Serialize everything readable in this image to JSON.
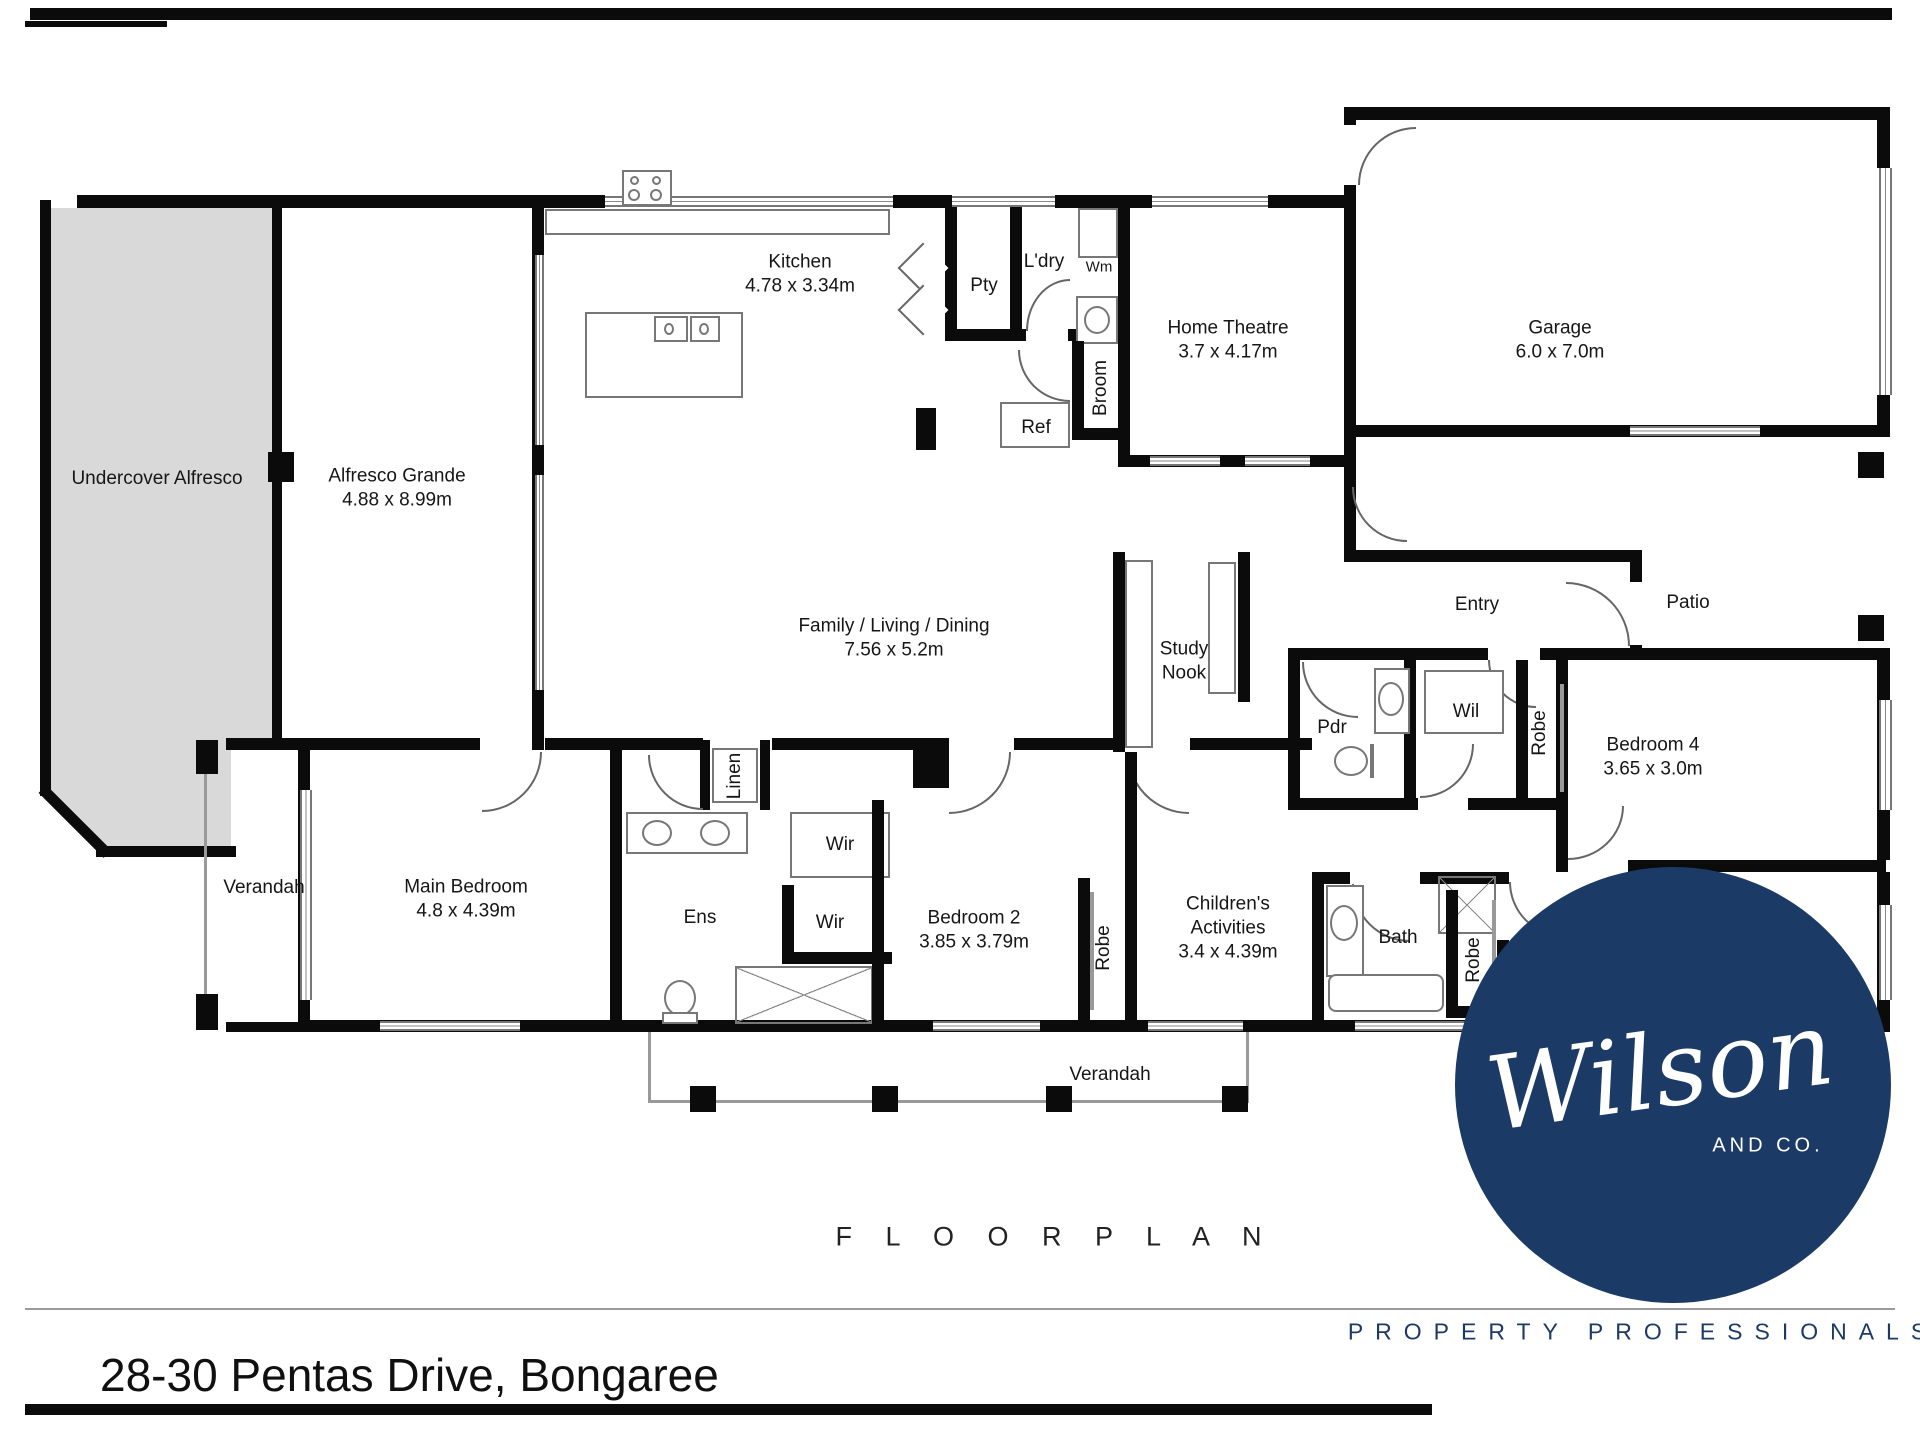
{
  "branding": {
    "address": "28-30 Pentas Drive, Bongaree",
    "floor_plan_title": "F L O O R   P L A N",
    "logo_name": "Wilson",
    "logo_sub": "AND CO.",
    "logo_tagline": "PROPERTY PROFESSIONALS",
    "navy": "#1b3a66",
    "gray_fill": "#d9d9d9",
    "wall_color": "#0b0b0b"
  },
  "plan": {
    "rooms": [
      {
        "id": "undercover-alfresco",
        "lines": [
          "Undercover Alfresco"
        ],
        "x": 157,
        "y": 479
      },
      {
        "id": "alfresco-grande",
        "lines": [
          "Alfresco Grande",
          "4.88 x 8.99m"
        ],
        "x": 397,
        "y": 488
      },
      {
        "id": "kitchen",
        "lines": [
          "Kitchen",
          "4.78 x 3.34m"
        ],
        "x": 800,
        "y": 274
      },
      {
        "id": "pty",
        "lines": [
          "Pty"
        ],
        "x": 984,
        "y": 286
      },
      {
        "id": "ldry",
        "lines": [
          "L'dry"
        ],
        "x": 1044,
        "y": 262
      },
      {
        "id": "wm",
        "lines": [
          "Wm"
        ],
        "x": 1099,
        "y": 268,
        "size": 15
      },
      {
        "id": "broom",
        "lines": [
          "Broom"
        ],
        "x": 1101,
        "y": 388,
        "vertical": true
      },
      {
        "id": "ref",
        "lines": [
          "Ref"
        ],
        "x": 1036,
        "y": 428
      },
      {
        "id": "home-theatre",
        "lines": [
          "Home Theatre",
          "3.7 x 4.17m"
        ],
        "x": 1228,
        "y": 340
      },
      {
        "id": "garage",
        "lines": [
          "Garage",
          "6.0 x 7.0m"
        ],
        "x": 1560,
        "y": 340
      },
      {
        "id": "family-living-dining",
        "lines": [
          "Family / Living / Dining",
          "7.56 x 5.2m"
        ],
        "x": 894,
        "y": 638
      },
      {
        "id": "study-nook",
        "lines": [
          "Study",
          "Nook"
        ],
        "x": 1184,
        "y": 661
      },
      {
        "id": "entry",
        "lines": [
          "Entry"
        ],
        "x": 1477,
        "y": 605
      },
      {
        "id": "patio",
        "lines": [
          "Patio"
        ],
        "x": 1688,
        "y": 603
      },
      {
        "id": "pdr",
        "lines": [
          "Pdr"
        ],
        "x": 1332,
        "y": 728
      },
      {
        "id": "wil",
        "lines": [
          "Wil"
        ],
        "x": 1466,
        "y": 712
      },
      {
        "id": "robe-bed4",
        "lines": [
          "Robe"
        ],
        "x": 1540,
        "y": 733,
        "vertical": true
      },
      {
        "id": "bedroom4",
        "lines": [
          "Bedroom 4",
          "3.65 x 3.0m"
        ],
        "x": 1653,
        "y": 757
      },
      {
        "id": "verandah-left",
        "lines": [
          "Verandah"
        ],
        "x": 264,
        "y": 888
      },
      {
        "id": "main-bedroom",
        "lines": [
          "Main Bedroom",
          "4.8 x 4.39m"
        ],
        "x": 466,
        "y": 899
      },
      {
        "id": "ens",
        "lines": [
          "Ens"
        ],
        "x": 700,
        "y": 918
      },
      {
        "id": "wir-upper",
        "lines": [
          "Wir"
        ],
        "x": 840,
        "y": 845
      },
      {
        "id": "wir-lower",
        "lines": [
          "Wir"
        ],
        "x": 830,
        "y": 923
      },
      {
        "id": "linen",
        "lines": [
          "Linen"
        ],
        "x": 735,
        "y": 776,
        "vertical": true
      },
      {
        "id": "bedroom2",
        "lines": [
          "Bedroom 2",
          "3.85 x 3.79m"
        ],
        "x": 974,
        "y": 930
      },
      {
        "id": "robe-bed2",
        "lines": [
          "Robe"
        ],
        "x": 1104,
        "y": 948,
        "vertical": true
      },
      {
        "id": "childrens-activities",
        "lines": [
          "Children's",
          "Activities",
          "3.4 x 4.39m"
        ],
        "x": 1228,
        "y": 928
      },
      {
        "id": "bath",
        "lines": [
          "Bath"
        ],
        "x": 1398,
        "y": 938
      },
      {
        "id": "robe-bed3",
        "lines": [
          "Robe"
        ],
        "x": 1474,
        "y": 960,
        "vertical": true
      },
      {
        "id": "bedroom3",
        "lines": [
          "Bedroom 3",
          "4.0 x 3.0m"
        ],
        "x": 1640,
        "y": 950
      },
      {
        "id": "verandah-bottom",
        "lines": [
          "Verandah"
        ],
        "x": 1110,
        "y": 1075
      }
    ]
  }
}
